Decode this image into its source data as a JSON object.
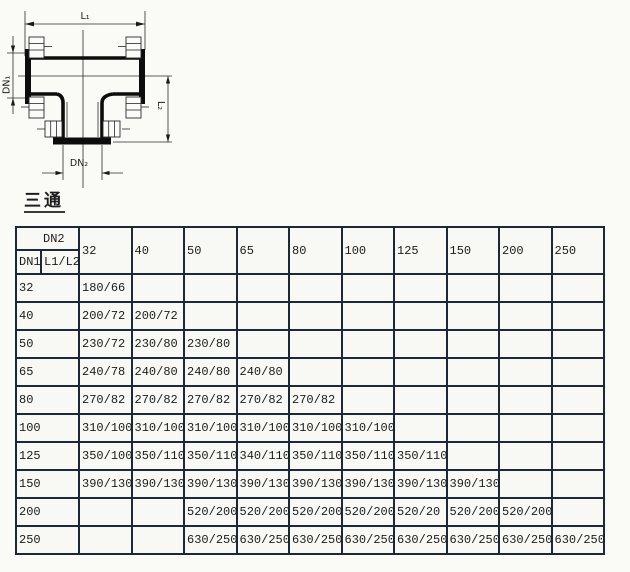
{
  "section": {
    "title": "三通"
  },
  "drawing": {
    "labels": {
      "l1": "L₁",
      "dn1": "DN₁",
      "l2": "L₂",
      "dn2": "DN₂"
    }
  },
  "table": {
    "corner": {
      "dn2": "DN2",
      "dn1": "DN1",
      "l1l2": "L1/L2"
    },
    "columns": [
      "32",
      "40",
      "50",
      "65",
      "80",
      "100",
      "125",
      "150",
      "200",
      "250"
    ],
    "rows": [
      {
        "dn1": "32",
        "values": [
          "180/66",
          "",
          "",
          "",
          "",
          "",
          "",
          "",
          "",
          ""
        ]
      },
      {
        "dn1": "40",
        "values": [
          "200/72",
          "200/72",
          "",
          "",
          "",
          "",
          "",
          "",
          "",
          ""
        ]
      },
      {
        "dn1": "50",
        "values": [
          "230/72",
          "230/80",
          "230/80",
          "",
          "",
          "",
          "",
          "",
          "",
          ""
        ]
      },
      {
        "dn1": "65",
        "values": [
          "240/78",
          "240/80",
          "240/80",
          "240/80",
          "",
          "",
          "",
          "",
          "",
          ""
        ]
      },
      {
        "dn1": "80",
        "values": [
          "270/82",
          "270/82",
          "270/82",
          "270/82",
          "270/82",
          "",
          "",
          "",
          "",
          ""
        ]
      },
      {
        "dn1": "100",
        "values": [
          "310/100",
          "310/100",
          "310/100",
          "310/100",
          "310/100",
          "310/100",
          "",
          "",
          "",
          ""
        ]
      },
      {
        "dn1": "125",
        "values": [
          "350/100",
          "350/110",
          "350/110",
          "340/110",
          "350/110",
          "350/110",
          "350/110",
          "",
          "",
          ""
        ]
      },
      {
        "dn1": "150",
        "values": [
          "390/130",
          "390/130",
          "390/130",
          "390/130",
          "390/130",
          "390/130",
          "390/130",
          "390/130",
          "",
          ""
        ]
      },
      {
        "dn1": "200",
        "values": [
          "",
          "",
          "520/200",
          "520/200",
          "520/200",
          "520/200",
          "520/20",
          "520/200",
          "520/200",
          ""
        ]
      },
      {
        "dn1": "250",
        "values": [
          "",
          "",
          "630/250",
          "630/250",
          "630/250",
          "630/250",
          "630/250",
          "630/250",
          "630/250",
          "630/250"
        ]
      }
    ]
  },
  "colors": {
    "table_border": "#1d2736",
    "line": "#0c0c0c",
    "text": "#1c1c1c",
    "background": "#fafaf7"
  }
}
